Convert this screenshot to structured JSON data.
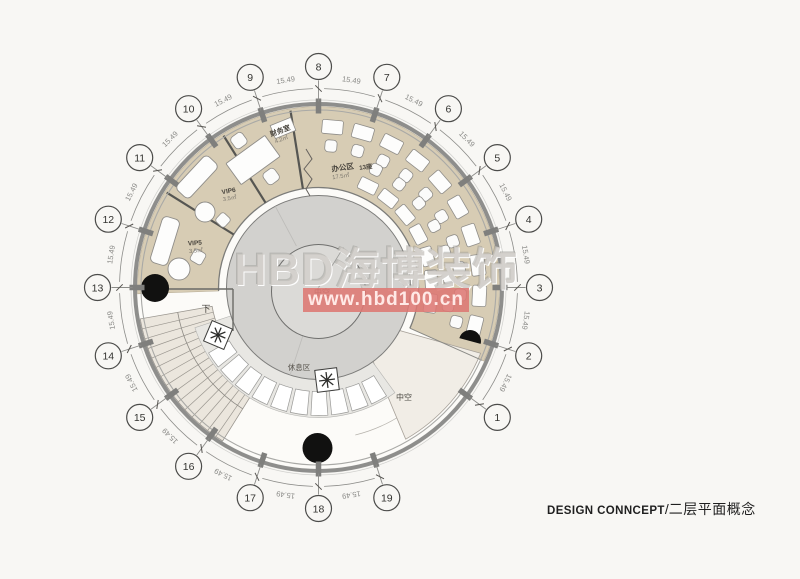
{
  "page": {
    "background": "#f8f7f4"
  },
  "watermark": {
    "brand": "HBD海博装饰",
    "url": "www.hbd100.cn"
  },
  "title_block": {
    "en": "DESIGN CONNCEPT",
    "separator": "/",
    "cn": "二层平面概念"
  },
  "plan": {
    "dim_label": "15.49",
    "grid_bubbles": [
      "1",
      "2",
      "3",
      "4",
      "5",
      "6",
      "7",
      "8",
      "9",
      "10",
      "11",
      "12",
      "13",
      "14",
      "15",
      "16",
      "17",
      "18",
      "19"
    ],
    "rooms": {
      "finance": {
        "name": "财务室",
        "area": "4.2㎡"
      },
      "office": {
        "name": "办公区",
        "seats": "13座",
        "area": "17.5㎡"
      },
      "vip6": {
        "name": "VIP6",
        "area": "3.5㎡"
      },
      "vip5": {
        "name": "VIP5",
        "area": "3.5㎡"
      },
      "rest": {
        "name": "休息区"
      },
      "atrium_center": {
        "name": "中空"
      },
      "atrium_lower": {
        "name": "中空"
      },
      "stairs": {
        "name": "下"
      }
    }
  }
}
